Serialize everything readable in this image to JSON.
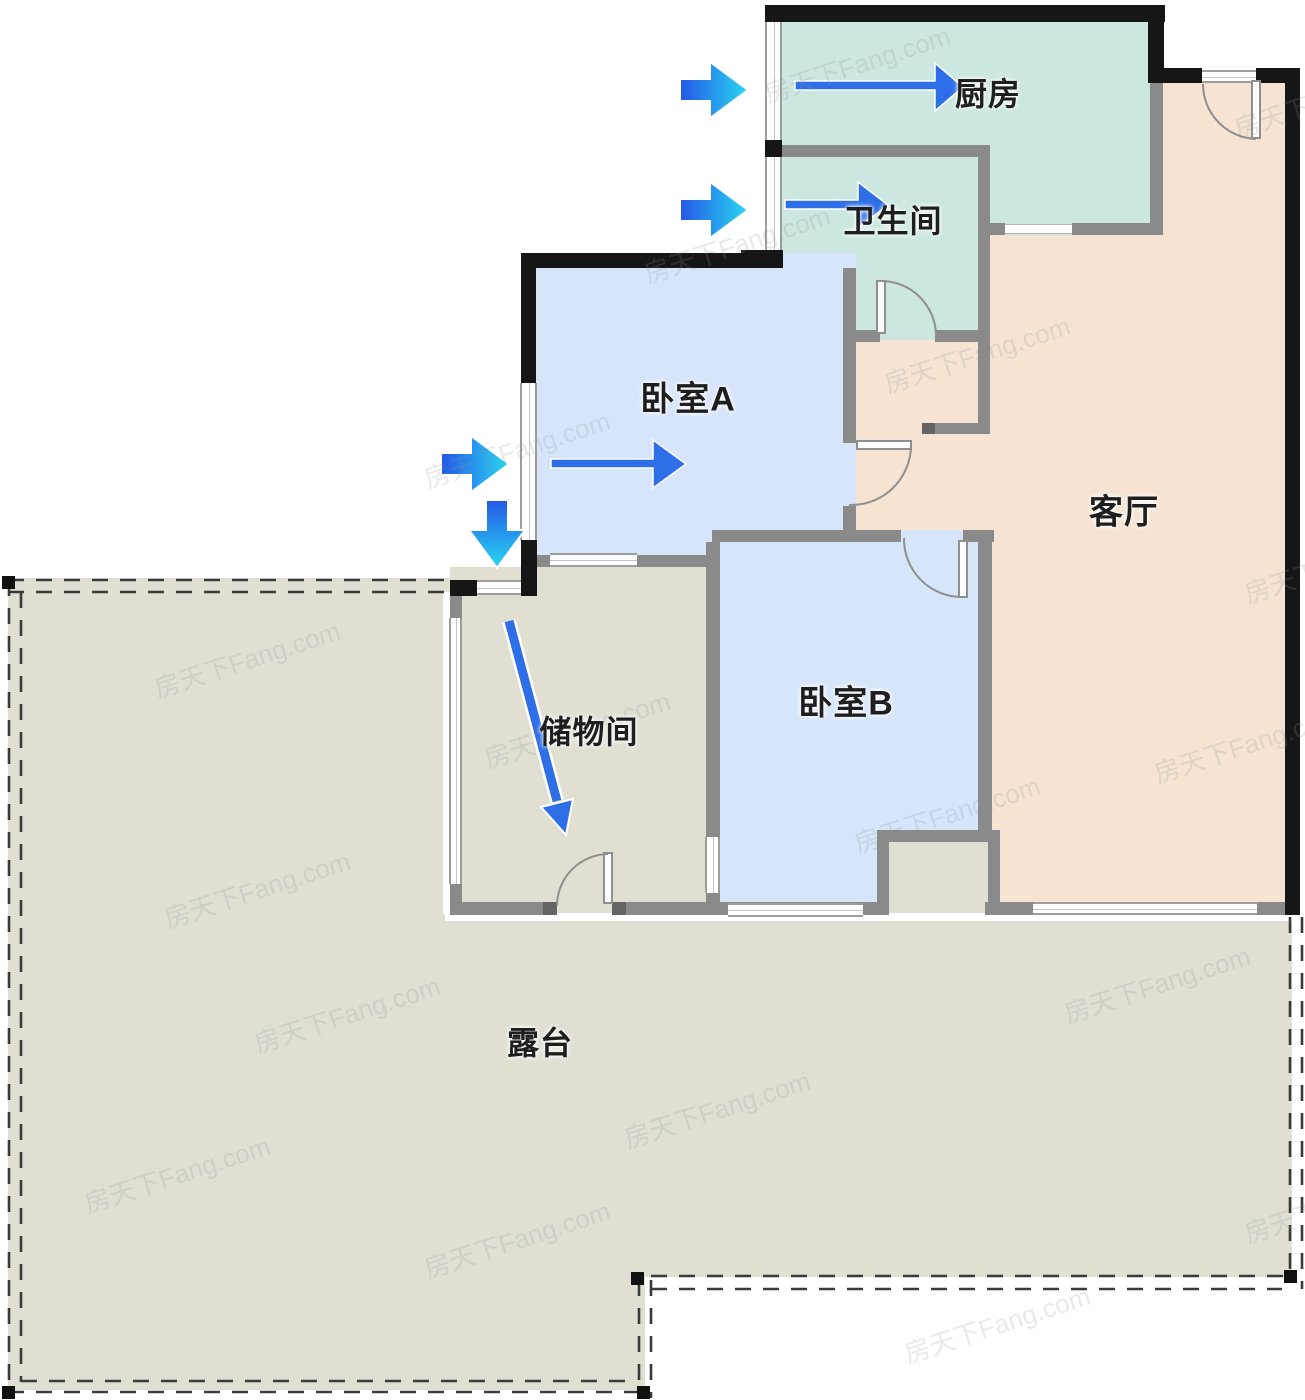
{
  "rooms": {
    "kitchen": {
      "label": "厨房"
    },
    "bathroom": {
      "label": "卫生间"
    },
    "bedroomA": {
      "label": "卧室A"
    },
    "livingRoom": {
      "label": "客厅"
    },
    "bedroomB": {
      "label": "卧室B"
    },
    "storage": {
      "label": "储物间"
    },
    "terrace": {
      "label": "露台"
    }
  },
  "arrows": [
    {
      "name": "airflow-arrow-kitchen-outside",
      "direction": "right"
    },
    {
      "name": "airflow-arrow-bathroom-outside",
      "direction": "right"
    },
    {
      "name": "airflow-arrow-bedroomA-outside",
      "direction": "right"
    },
    {
      "name": "airflow-arrow-terrace-outside",
      "direction": "down"
    },
    {
      "name": "airflow-arrow-kitchen-inside",
      "direction": "right"
    },
    {
      "name": "airflow-arrow-bathroom-inside",
      "direction": "right"
    },
    {
      "name": "airflow-arrow-bedroomA-inside",
      "direction": "right"
    },
    {
      "name": "airflow-arrow-storage-inside",
      "direction": "down-right"
    }
  ],
  "watermark": {
    "text": "房天下Fang.com"
  },
  "colors": {
    "kitchen_fill": "#cbe7df",
    "bedroom_fill": "#d7e5fa",
    "living_fill": "#f6e3d1",
    "terrace_fill": "#e0dfd2",
    "wall_black": "#161616",
    "wall_gray": "#8a8a8a",
    "arrow_blue": "#2e6fe8",
    "arrow_cyan": "#29d8f2",
    "dash_color": "#3a3a3a"
  }
}
